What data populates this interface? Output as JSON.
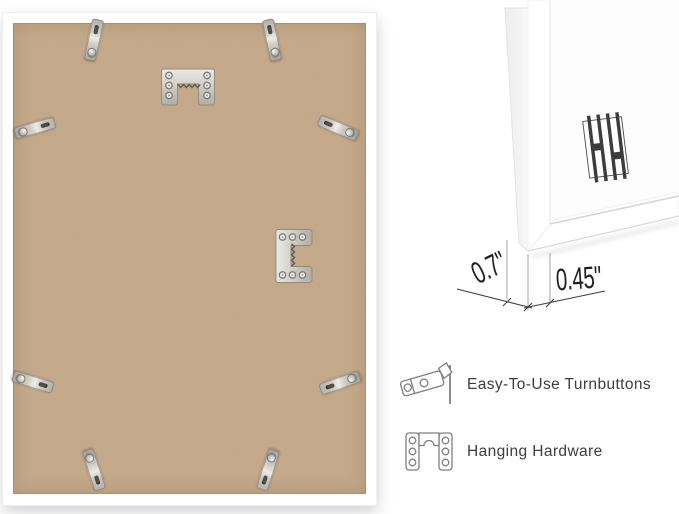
{
  "page": {
    "background": "#ffffff"
  },
  "frame_back": {
    "description": "back of white picture frame with MDF board",
    "board_color": "#c6a98a",
    "frame_color": "#ffffff",
    "turnbutton_count": 8,
    "hanger_positions": [
      "top-center",
      "right-middle"
    ]
  },
  "corner_detail": {
    "depth_dimension": "0.7\"",
    "face_dimension": "0.45\"",
    "logo_monogram": "HH"
  },
  "features": [
    {
      "icon": "turnbutton-icon",
      "label": "Easy-To-Use Turnbuttons"
    },
    {
      "icon": "hanging-hardware-icon",
      "label": "Hanging Hardware"
    }
  ],
  "colors": {
    "dimension_text": "#212121",
    "feature_text": "#3e3e3e",
    "icon_stroke": "#7f7f7f",
    "dimension_line": "#3f3f3f",
    "extension_line": "#9b9b9b",
    "metal": "#cbc8c2"
  }
}
